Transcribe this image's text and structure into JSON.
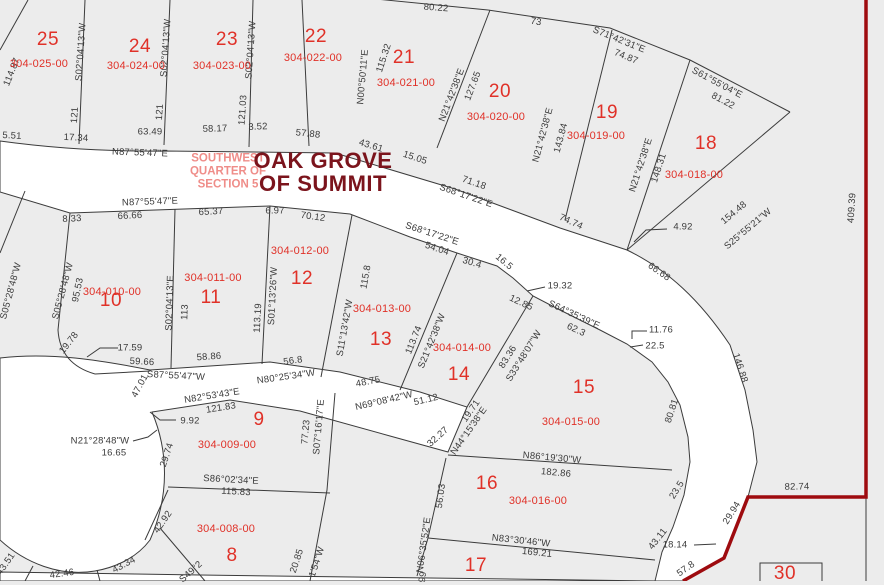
{
  "map": {
    "title_line1": "OAK GROVE",
    "title_line2": "OF SUMMIT",
    "subtitle_line1": "SOUTHWEST",
    "subtitle_line2": "QUARTER OF",
    "subtitle_line3": "SECTION 5"
  },
  "colors": {
    "parcel_fill": "#ececec",
    "road_fill": "#ffffff",
    "line": "#3b3b3b",
    "lot_red": "#e03128",
    "subtitle_salmon": "#ef8d89",
    "title_maroon": "#7b141c",
    "boundary_red": "#9e0b0f"
  },
  "lots": [
    {
      "num": "25",
      "id": "304-025-00",
      "nx": 48,
      "ny": 40,
      "ix": 39,
      "iy": 64
    },
    {
      "num": "24",
      "id": "304-024-00",
      "nx": 140,
      "ny": 47,
      "ix": 136,
      "iy": 66
    },
    {
      "num": "23",
      "id": "304-023-00",
      "nx": 227,
      "ny": 40,
      "ix": 222,
      "iy": 66
    },
    {
      "num": "22",
      "id": "304-022-00",
      "nx": 316,
      "ny": 37,
      "ix": 313,
      "iy": 58
    },
    {
      "num": "21",
      "id": "304-021-00",
      "nx": 404,
      "ny": 58,
      "ix": 406,
      "iy": 83
    },
    {
      "num": "20",
      "id": "304-020-00",
      "nx": 500,
      "ny": 92,
      "ix": 496,
      "iy": 117
    },
    {
      "num": "19",
      "id": "304-019-00",
      "nx": 607,
      "ny": 113,
      "ix": 596,
      "iy": 136
    },
    {
      "num": "18",
      "id": "304-018-00",
      "nx": 706,
      "ny": 144,
      "ix": 694,
      "iy": 175
    },
    {
      "num": "10",
      "id": "304-010-00",
      "nx": 111,
      "ny": 301,
      "ix": 112,
      "iy": 292
    },
    {
      "num": "11",
      "id": "304-011-00",
      "nx": 211,
      "ny": 298,
      "ix": 213,
      "iy": 278
    },
    {
      "num": "12",
      "id": "304-012-00",
      "nx": 302,
      "ny": 279,
      "ix": 300,
      "iy": 251
    },
    {
      "num": "13",
      "id": "304-013-00",
      "nx": 381,
      "ny": 340,
      "ix": 382,
      "iy": 309
    },
    {
      "num": "14",
      "id": "304-014-00",
      "nx": 459,
      "ny": 375,
      "ix": 462,
      "iy": 348
    },
    {
      "num": "15",
      "id": "304-015-00",
      "nx": 584,
      "ny": 388,
      "ix": 571,
      "iy": 422
    },
    {
      "num": "16",
      "id": "304-016-00",
      "nx": 487,
      "ny": 484,
      "ix": 538,
      "iy": 501
    },
    {
      "num": "17",
      "id": "",
      "nx": 476,
      "ny": 566,
      "ix": 0,
      "iy": 0
    },
    {
      "num": "9",
      "id": "304-009-00",
      "nx": 259,
      "ny": 420,
      "ix": 227,
      "iy": 445
    },
    {
      "num": "8",
      "id": "304-008-00",
      "nx": 232,
      "ny": 556,
      "ix": 226,
      "iy": 529
    },
    {
      "num": "30",
      "id": "",
      "nx": 785,
      "ny": 574,
      "ix": 0,
      "iy": 0
    }
  ],
  "measurements": [
    {
      "text": "S02°04'13\"W",
      "x": 81,
      "y": 52,
      "rot": -86
    },
    {
      "text": "121",
      "x": 75,
      "y": 115,
      "rot": -86
    },
    {
      "text": "S02°04'13\"W",
      "x": 166,
      "y": 48,
      "rot": -86
    },
    {
      "text": "121",
      "x": 160,
      "y": 112,
      "rot": -86
    },
    {
      "text": "S02°04'13\"W",
      "x": 251,
      "y": 50,
      "rot": -86
    },
    {
      "text": "121.03",
      "x": 243,
      "y": 110,
      "rot": -86
    },
    {
      "text": "114.87",
      "x": 12,
      "y": 72,
      "rot": -68
    },
    {
      "text": "80.22",
      "x": 436,
      "y": 8,
      "rot": 4
    },
    {
      "text": "73",
      "x": 536,
      "y": 22,
      "rot": 9
    },
    {
      "text": "S71°42'31\"E",
      "x": 619,
      "y": 40,
      "rot": 22
    },
    {
      "text": "74.87",
      "x": 626,
      "y": 57,
      "rot": 22
    },
    {
      "text": "S61°55'04\"E",
      "x": 717,
      "y": 83,
      "rot": 28
    },
    {
      "text": "81.22",
      "x": 723,
      "y": 101,
      "rot": 28
    },
    {
      "text": "N00°50'11\"E",
      "x": 363,
      "y": 77,
      "rot": -85
    },
    {
      "text": "115.32",
      "x": 384,
      "y": 58,
      "rot": -72
    },
    {
      "text": "N21°42'38\"E",
      "x": 452,
      "y": 95,
      "rot": -69
    },
    {
      "text": "127.65",
      "x": 473,
      "y": 86,
      "rot": -69
    },
    {
      "text": "N21°42'38\"E",
      "x": 543,
      "y": 135,
      "rot": -75
    },
    {
      "text": "143.84",
      "x": 561,
      "y": 138,
      "rot": -75
    },
    {
      "text": "N21°42'38\"E",
      "x": 641,
      "y": 165,
      "rot": -72
    },
    {
      "text": "148.31",
      "x": 659,
      "y": 168,
      "rot": -72
    },
    {
      "text": "S25°55'21\"W",
      "x": 748,
      "y": 229,
      "rot": -40
    },
    {
      "text": "154.48",
      "x": 734,
      "y": 213,
      "rot": -40
    },
    {
      "text": "409.39",
      "x": 852,
      "y": 208,
      "rot": -86
    },
    {
      "text": "5.51",
      "x": 12,
      "y": 136,
      "rot": 3
    },
    {
      "text": "17.34",
      "x": 76,
      "y": 138,
      "rot": 3
    },
    {
      "text": "63.49",
      "x": 150,
      "y": 132,
      "rot": 0
    },
    {
      "text": "58.17",
      "x": 215,
      "y": 129,
      "rot": -2
    },
    {
      "text": "3.52",
      "x": 258,
      "y": 127,
      "rot": -2
    },
    {
      "text": "57.88",
      "x": 308,
      "y": 134,
      "rot": 6
    },
    {
      "text": "43.61",
      "x": 371,
      "y": 146,
      "rot": 17
    },
    {
      "text": "15.05",
      "x": 415,
      "y": 158,
      "rot": 18
    },
    {
      "text": "N87°55'47\"E",
      "x": 140,
      "y": 153,
      "rot": 2
    },
    {
      "text": "S68°17'22\"E",
      "x": 466,
      "y": 196,
      "rot": 19
    },
    {
      "text": "71.18",
      "x": 474,
      "y": 183,
      "rot": 19
    },
    {
      "text": "74.74",
      "x": 571,
      "y": 222,
      "rot": 24
    },
    {
      "text": "4.92",
      "x": 683,
      "y": 227,
      "rot": 0
    },
    {
      "text": "66.68",
      "x": 659,
      "y": 272,
      "rot": 35
    },
    {
      "text": "N87°55'47\"E",
      "x": 150,
      "y": 202,
      "rot": -2
    },
    {
      "text": "8.33",
      "x": 72,
      "y": 219,
      "rot": -3
    },
    {
      "text": "66.66",
      "x": 130,
      "y": 216,
      "rot": -3
    },
    {
      "text": "65.37",
      "x": 211,
      "y": 212,
      "rot": -3
    },
    {
      "text": "6.97",
      "x": 275,
      "y": 211,
      "rot": 0
    },
    {
      "text": "70.12",
      "x": 313,
      "y": 217,
      "rot": 8
    },
    {
      "text": "S68°17'22\"E",
      "x": 432,
      "y": 234,
      "rot": 18
    },
    {
      "text": "54.04",
      "x": 437,
      "y": 249,
      "rot": 18
    },
    {
      "text": "30.4",
      "x": 472,
      "y": 263,
      "rot": 17
    },
    {
      "text": "16.5",
      "x": 504,
      "y": 262,
      "rot": 40
    },
    {
      "text": "12.85",
      "x": 521,
      "y": 303,
      "rot": 25
    },
    {
      "text": "19.32",
      "x": 560,
      "y": 286,
      "rot": 0
    },
    {
      "text": "S64°35'39\"E",
      "x": 574,
      "y": 315,
      "rot": 25
    },
    {
      "text": "62.3",
      "x": 576,
      "y": 330,
      "rot": 25
    },
    {
      "text": "11.76",
      "x": 661,
      "y": 330,
      "rot": 0
    },
    {
      "text": "22.5",
      "x": 655,
      "y": 346,
      "rot": 0
    },
    {
      "text": "146.88",
      "x": 740,
      "y": 368,
      "rot": 72
    },
    {
      "text": "S05°28'48\"W",
      "x": 11,
      "y": 291,
      "rot": -75
    },
    {
      "text": "S05°28'48\"W",
      "x": 63,
      "y": 291,
      "rot": -75
    },
    {
      "text": "95.53",
      "x": 78,
      "y": 290,
      "rot": -78
    },
    {
      "text": "19.78",
      "x": 69,
      "y": 343,
      "rot": -52
    },
    {
      "text": "S02°04'13\"E",
      "x": 170,
      "y": 303,
      "rot": -88
    },
    {
      "text": "113",
      "x": 185,
      "y": 312,
      "rot": -88
    },
    {
      "text": "S01°13'26\"W",
      "x": 273,
      "y": 296,
      "rot": -87
    },
    {
      "text": "113.19",
      "x": 258,
      "y": 318,
      "rot": -87
    },
    {
      "text": "S11°13'42\"W",
      "x": 345,
      "y": 328,
      "rot": -80
    },
    {
      "text": "115.8",
      "x": 366,
      "y": 277,
      "rot": -80
    },
    {
      "text": "S21°42'38\"W",
      "x": 432,
      "y": 341,
      "rot": -68
    },
    {
      "text": "113.74",
      "x": 414,
      "y": 340,
      "rot": -68
    },
    {
      "text": "S33°48'07\"W",
      "x": 524,
      "y": 356,
      "rot": -58
    },
    {
      "text": "83.36",
      "x": 508,
      "y": 357,
      "rot": -58
    },
    {
      "text": "17.59",
      "x": 130,
      "y": 348,
      "rot": 0
    },
    {
      "text": "59.66",
      "x": 142,
      "y": 362,
      "rot": 3
    },
    {
      "text": "S87°55'47\"W",
      "x": 176,
      "y": 376,
      "rot": 3
    },
    {
      "text": "58.86",
      "x": 209,
      "y": 357,
      "rot": -4
    },
    {
      "text": "N80°25'34\"W",
      "x": 286,
      "y": 377,
      "rot": -8
    },
    {
      "text": "56.8",
      "x": 293,
      "y": 361,
      "rot": -8
    },
    {
      "text": "48.75",
      "x": 368,
      "y": 382,
      "rot": -11
    },
    {
      "text": "N69°08'42\"W",
      "x": 384,
      "y": 401,
      "rot": -13
    },
    {
      "text": "51.12",
      "x": 426,
      "y": 400,
      "rot": -13
    },
    {
      "text": "19.71",
      "x": 471,
      "y": 411,
      "rot": -55
    },
    {
      "text": "N44°15'38\"E",
      "x": 469,
      "y": 431,
      "rot": -55
    },
    {
      "text": "32.27",
      "x": 438,
      "y": 437,
      "rot": -42
    },
    {
      "text": "47.01",
      "x": 140,
      "y": 386,
      "rot": -62
    },
    {
      "text": "N82°53'43\"E",
      "x": 212,
      "y": 396,
      "rot": -9
    },
    {
      "text": "121.83",
      "x": 221,
      "y": 408,
      "rot": -9
    },
    {
      "text": "9.92",
      "x": 190,
      "y": 421,
      "rot": 0
    },
    {
      "text": "N21°28'48\"W",
      "x": 100,
      "y": 441,
      "rot": 0
    },
    {
      "text": "16.65",
      "x": 114,
      "y": 453,
      "rot": 0
    },
    {
      "text": "29.74",
      "x": 167,
      "y": 455,
      "rot": -72
    },
    {
      "text": "S07°16'17\"E",
      "x": 319,
      "y": 427,
      "rot": -85
    },
    {
      "text": "77.23",
      "x": 306,
      "y": 432,
      "rot": -85
    },
    {
      "text": "S86°02'34\"E",
      "x": 231,
      "y": 480,
      "rot": 3
    },
    {
      "text": "115.83",
      "x": 236,
      "y": 492,
      "rot": 3
    },
    {
      "text": "42.92",
      "x": 163,
      "y": 522,
      "rot": -55
    },
    {
      "text": "43.34",
      "x": 124,
      "y": 565,
      "rot": -28
    },
    {
      "text": "42.46",
      "x": 62,
      "y": 574,
      "rot": -8
    },
    {
      "text": "43.51",
      "x": 6,
      "y": 564,
      "rot": -55
    },
    {
      "text": "S49°2",
      "x": 191,
      "y": 572,
      "rot": -42
    },
    {
      "text": "20.85",
      "x": 297,
      "y": 561,
      "rot": -72
    },
    {
      "text": "1'54\"W",
      "x": 317,
      "y": 562,
      "rot": -72
    },
    {
      "text": "N86°19'30\"W",
      "x": 552,
      "y": 458,
      "rot": 5
    },
    {
      "text": "182.86",
      "x": 556,
      "y": 473,
      "rot": 5
    },
    {
      "text": "56.03",
      "x": 441,
      "y": 496,
      "rot": -82
    },
    {
      "text": "N06°35'52\"E",
      "x": 424,
      "y": 545,
      "rot": -82
    },
    {
      "text": "99",
      "x": 423,
      "y": 577,
      "rot": -82
    },
    {
      "text": "N83°30'46\"W",
      "x": 521,
      "y": 541,
      "rot": 6
    },
    {
      "text": "169.21",
      "x": 537,
      "y": 553,
      "rot": 6
    },
    {
      "text": "80.81",
      "x": 672,
      "y": 411,
      "rot": -72
    },
    {
      "text": "23.5",
      "x": 677,
      "y": 490,
      "rot": -58
    },
    {
      "text": "43.11",
      "x": 658,
      "y": 539,
      "rot": -52
    },
    {
      "text": "18.14",
      "x": 675,
      "y": 545,
      "rot": 0
    },
    {
      "text": "29.94",
      "x": 732,
      "y": 513,
      "rot": -58
    },
    {
      "text": "57.8",
      "x": 686,
      "y": 569,
      "rot": -35
    },
    {
      "text": "82.74",
      "x": 797,
      "y": 487,
      "rot": -1
    }
  ]
}
